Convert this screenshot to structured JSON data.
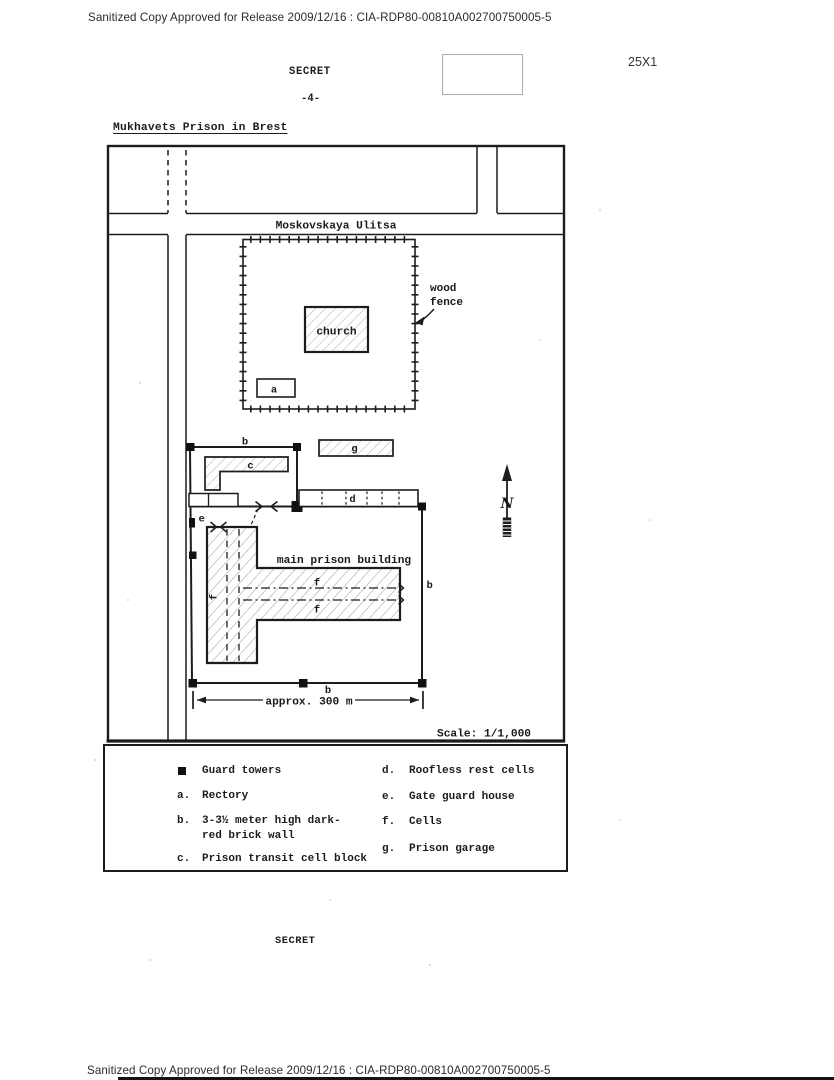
{
  "colors": {
    "ink": "#1c1c1c",
    "paper": "#ffffff",
    "redaction_border": "#ababab",
    "scan_text": "#2b2b2b"
  },
  "header": {
    "text": "Sanitized Copy Approved for Release 2009/12/16 : CIA-RDP80-00810A002700750005-5"
  },
  "footer": {
    "text": "Sanitized Copy Approved for Release 2009/12/16 : CIA-RDP80-00810A002700750005-5"
  },
  "stamps": {
    "secret_top": "SECRET",
    "secret_bottom": "SECRET",
    "page_number": "-4-",
    "margin_code": "25X1"
  },
  "document": {
    "title": "Mukhavets Prison in Brest"
  },
  "map": {
    "street": "Moskovskaya Ulitsa",
    "wood_fence_line1": "wood",
    "wood_fence_line2": "fence",
    "church": "church",
    "main_building": "main prison building",
    "north": "N",
    "dimension": "approx. 300 m",
    "scale": "Scale: 1/1,000",
    "labels": {
      "a": "a",
      "b_top": "b",
      "b_right": "b",
      "b_bottom": "b",
      "c": "c",
      "d": "d",
      "e": "e",
      "f_west": "f",
      "f_upper": "f",
      "f_lower": "f",
      "g": "g"
    }
  },
  "legend": {
    "left": [
      {
        "symbol": "black-square",
        "label": "Guard towers"
      },
      {
        "key": "a.",
        "label": "Rectory"
      },
      {
        "key": "b.",
        "label": "3-3½ meter high dark-",
        "label2": "red brick wall"
      },
      {
        "key": "c.",
        "label": "Prison transit cell block"
      }
    ],
    "right": [
      {
        "key": "d.",
        "label": "Roofless rest cells"
      },
      {
        "key": "e.",
        "label": "Gate guard house"
      },
      {
        "key": "f.",
        "label": "Cells"
      },
      {
        "key": "g.",
        "label": "Prison garage"
      }
    ]
  }
}
